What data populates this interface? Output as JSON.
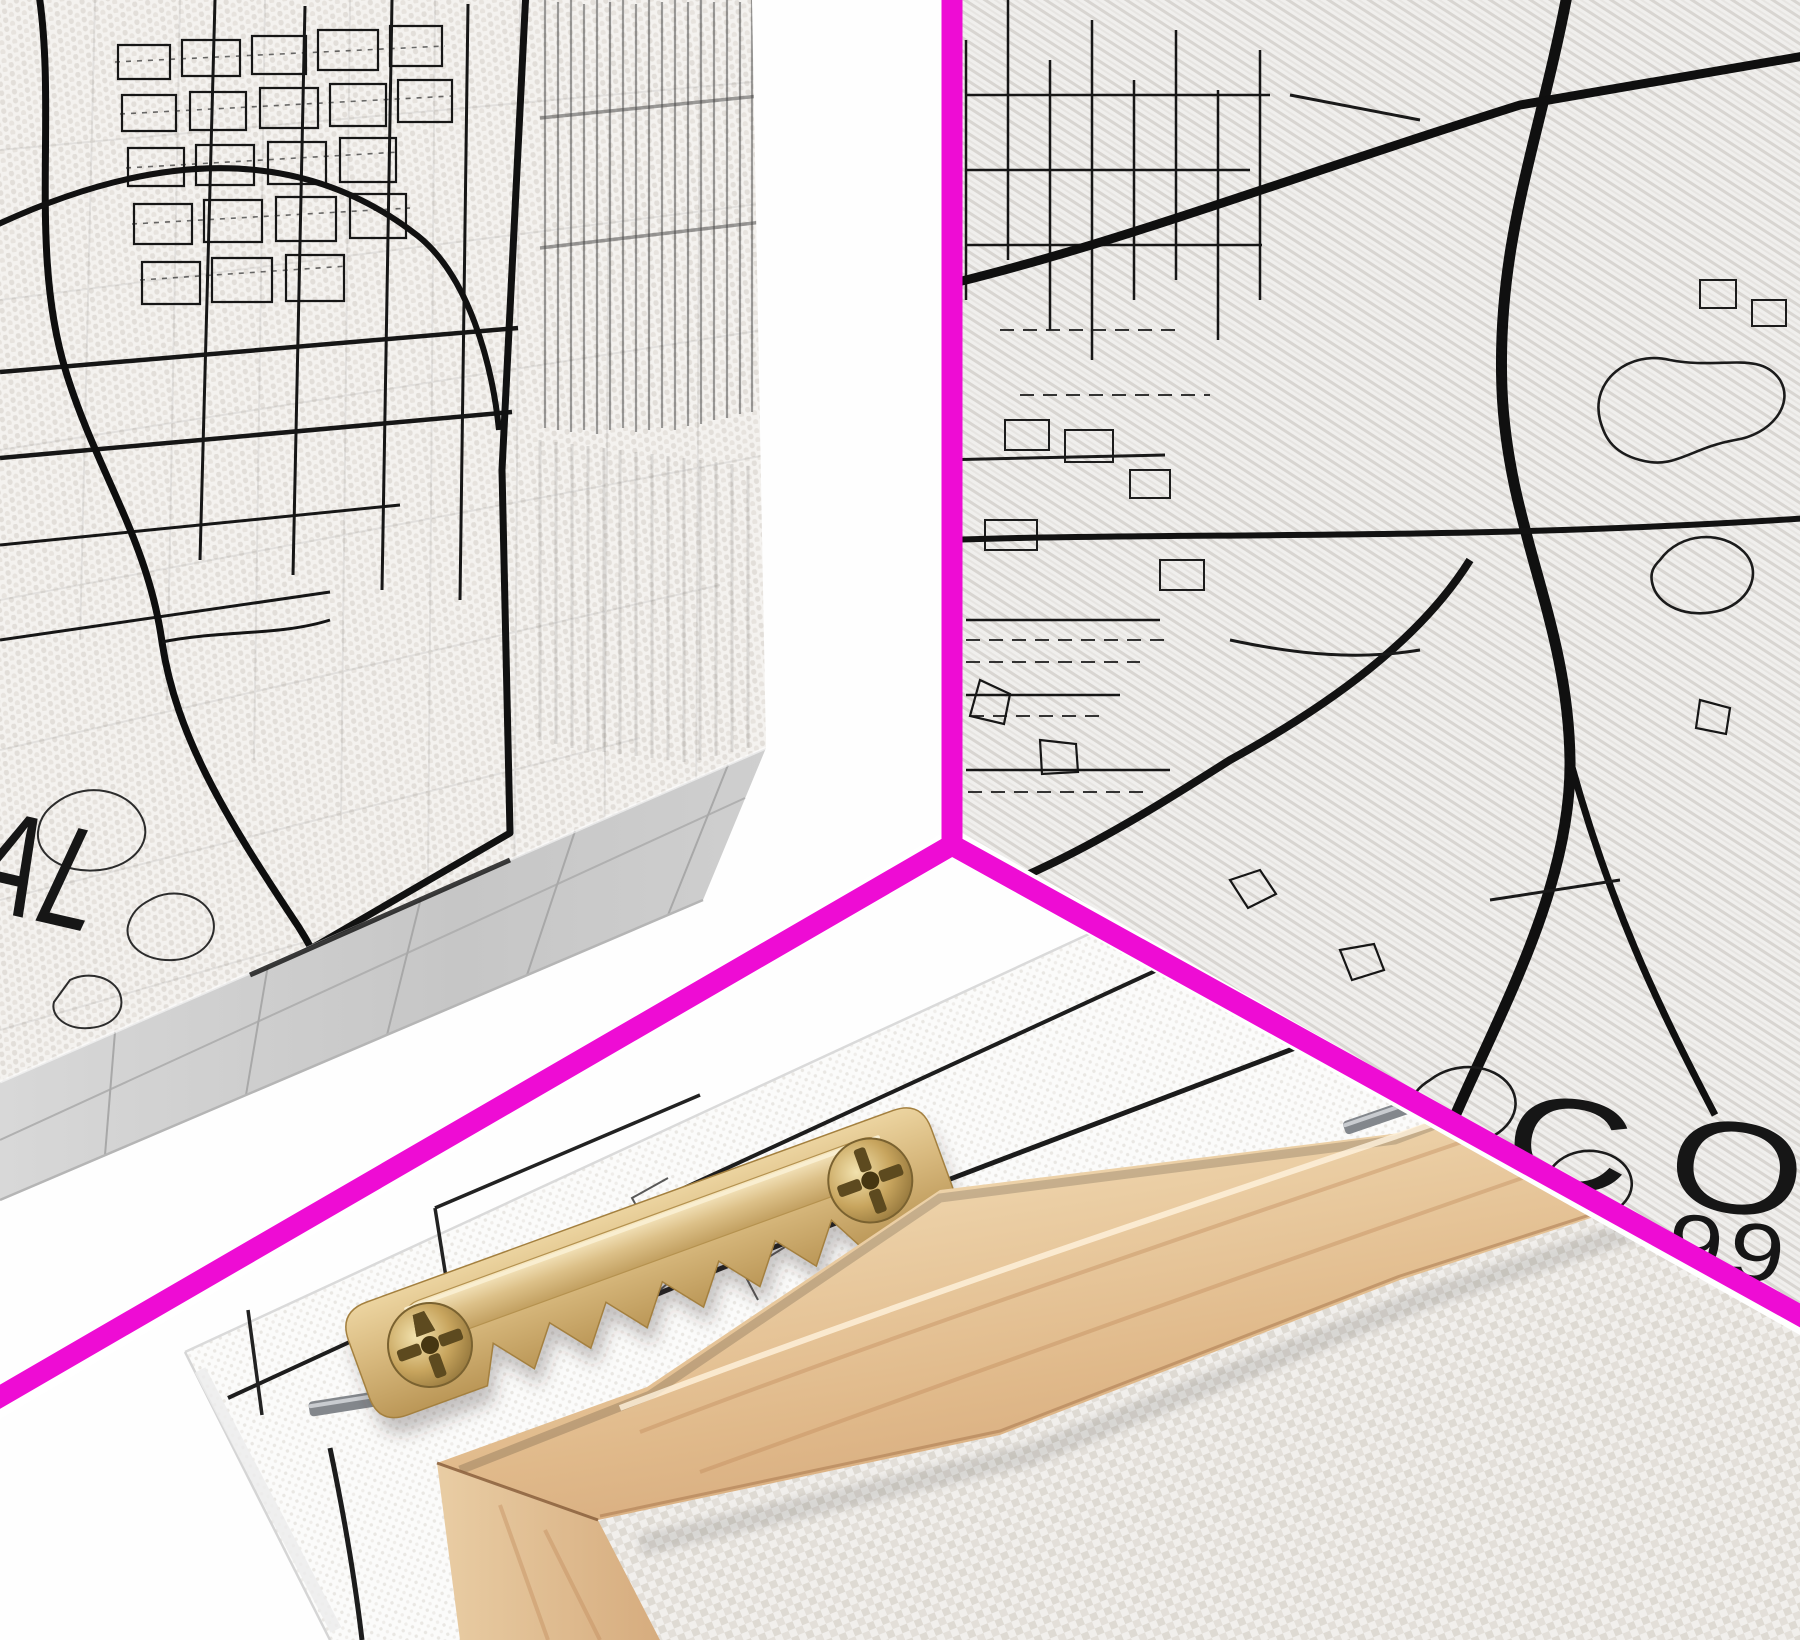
{
  "collage": {
    "panel_count": 3,
    "panels": {
      "top_left": {
        "label_fragment": "AL"
      },
      "top_right": {
        "title_fragment": "CO",
        "coordinate_fragment": "99"
      },
      "bottom": {}
    }
  },
  "colors": {
    "divider": "#EE0CD4",
    "map_ink": "#161616",
    "photo_background": "#FEFEFE",
    "canvas_white": "#FBFBFA",
    "canvas_shadow_gray": "#C9C9C9",
    "wood_light": "#F4E4C8",
    "wood_mid": "#E5C399",
    "wood_dark": "#C9996B",
    "brass": "#D3B277",
    "brass_dark": "#A3804A",
    "staple": "#83878C"
  }
}
